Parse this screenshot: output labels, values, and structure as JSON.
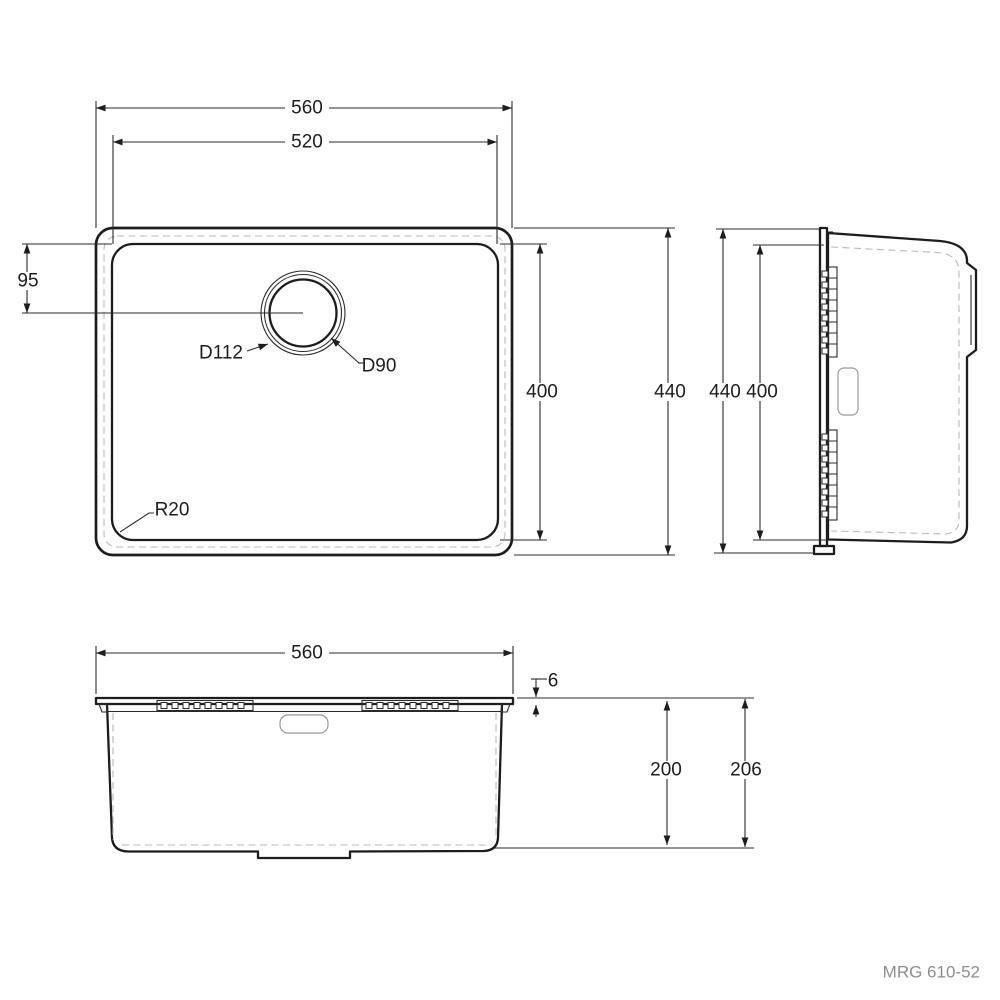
{
  "plan_view": {
    "dimensions": {
      "outer_width_mm": "560",
      "inner_width_mm": "520",
      "drain_center_offset_mm": "95",
      "inner_length_mm": "400",
      "outer_length_mm": "440",
      "drain_flange_diameter": "D112",
      "drain_hole_diameter": "D90",
      "corner_radius": "R20"
    }
  },
  "side_view": {
    "dimensions": {
      "outer_length_mm": "440",
      "inner_length_mm": "400"
    }
  },
  "front_view": {
    "dimensions": {
      "outer_width_mm": "560",
      "rim_thickness_mm": "6",
      "bowl_depth_mm": "200",
      "overall_depth_mm": "206"
    }
  },
  "footer": {
    "model_number": "MRG 610-52"
  },
  "colors": {
    "line": "#1d1d1d",
    "hidden_line": "#b9b9b9",
    "model_text": "#8e8e8e"
  }
}
